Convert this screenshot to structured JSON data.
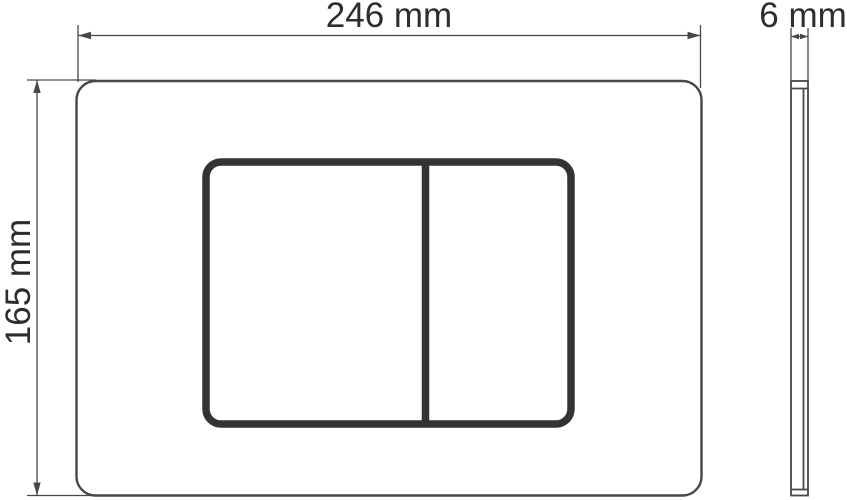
{
  "drawing": {
    "kind": "technical-dimension-drawing",
    "subject": "dual-flush actuator wall plate, front view and side profile"
  },
  "dimensions": {
    "width": {
      "label": "246 mm",
      "value": 246,
      "unit": "mm"
    },
    "height": {
      "label": "165 mm",
      "value": 165,
      "unit": "mm"
    },
    "depth": {
      "label": "6 mm",
      "value": 6,
      "unit": "mm"
    }
  },
  "colors": {
    "background": "#ffffff",
    "thin_line": "#474747",
    "thick_line": "#333333",
    "text": "#2d2d2d"
  }
}
